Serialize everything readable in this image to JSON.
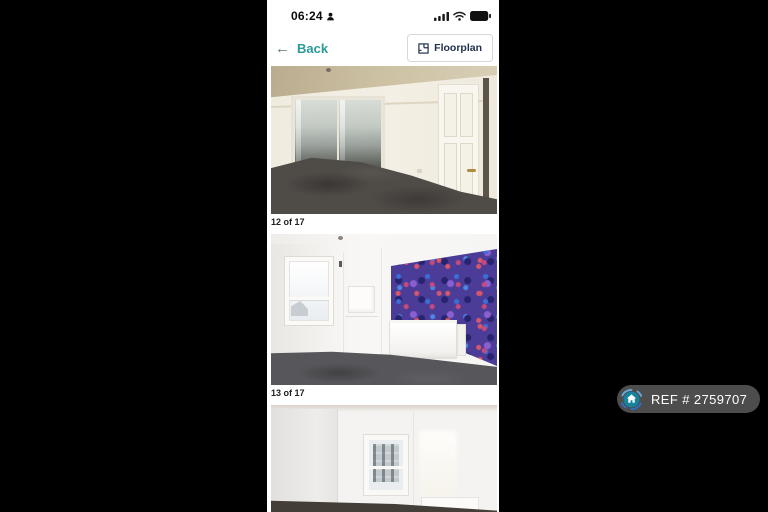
{
  "status_bar": {
    "time": "06:24"
  },
  "nav": {
    "back_label": "Back",
    "floorplan_label": "Floorplan"
  },
  "gallery": {
    "photos": [
      {
        "caption": "12 of 17",
        "alt": "bedroom-with-mirrored-wardrobe"
      },
      {
        "caption": "13 of 17",
        "alt": "bedroom-with-purple-feature-wall"
      },
      {
        "caption": "",
        "alt": "room-with-window-partially-visible"
      }
    ]
  },
  "watermark": {
    "ref_label": "REF # 2759707"
  },
  "colors": {
    "accent_teal": "#2a9a98",
    "navy_text": "#22304f",
    "caption_text": "#222222",
    "badge_background": "#4d4d4d",
    "badge_text": "#ffffff",
    "wallpaper_purple": "#4b3c98",
    "letterbox": "#000000"
  }
}
